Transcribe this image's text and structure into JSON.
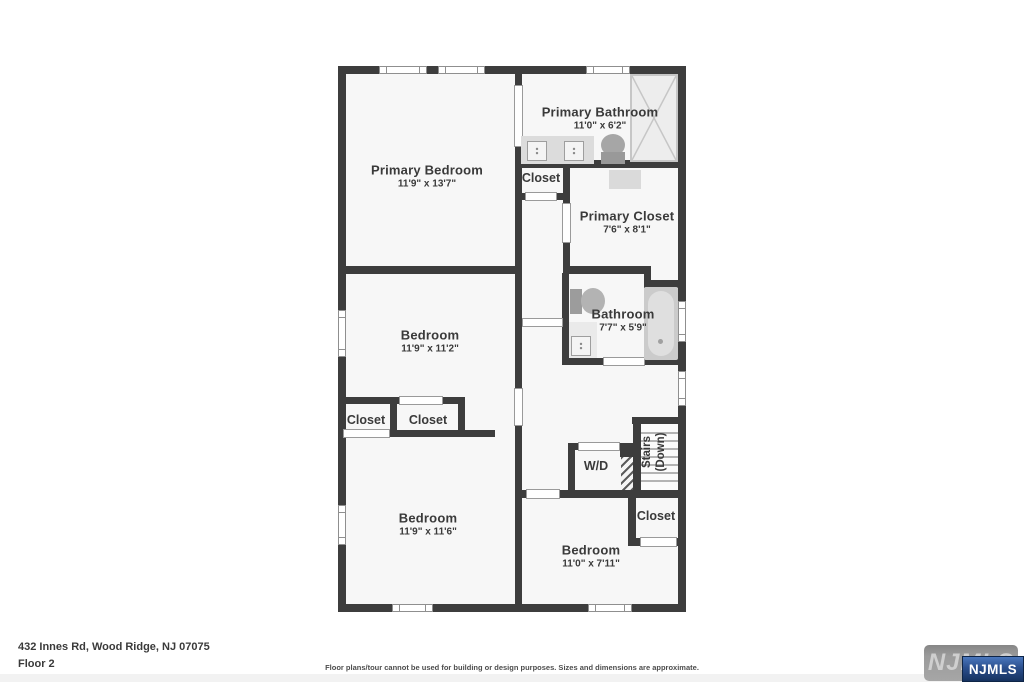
{
  "colors": {
    "wall": "#3d3d3d",
    "floor": "#f7f7f7",
    "label": "#3a3a3a",
    "logo_blue": "#16325f"
  },
  "rooms": {
    "primary_bedroom": {
      "name": "Primary Bedroom",
      "dims": "11'9\" x 13'7\""
    },
    "primary_bathroom": {
      "name": "Primary Bathroom",
      "dims": "11'0\" x 6'2\""
    },
    "hall_closet": {
      "name": "Closet"
    },
    "primary_closet": {
      "name": "Primary Closet",
      "dims": "7'6\" x 8'1\""
    },
    "bedroom_middle": {
      "name": "Bedroom",
      "dims": "11'9\" x 11'2\""
    },
    "bathroom": {
      "name": "Bathroom",
      "dims": "7'7\" x 5'9\""
    },
    "closet_left": {
      "name": "Closet"
    },
    "closet_center": {
      "name": "Closet"
    },
    "laundry": {
      "name": "W/D"
    },
    "stairs": {
      "name": "Stairs",
      "direction": "(Down)"
    },
    "bedroom_bottom_left": {
      "name": "Bedroom",
      "dims": "11'9\" x 11'6\""
    },
    "bedroom_bottom_right": {
      "name": "Bedroom",
      "dims": "11'0\" x 7'11\""
    },
    "closet_bottom_right": {
      "name": "Closet"
    }
  },
  "footer": {
    "address": "432 Innes Rd, Wood Ridge, NJ 07075",
    "floor_label": "Floor 2",
    "disclaimer": "Floor plans/tour cannot be used for building or design purposes. Sizes and dimensions are approximate."
  },
  "logo": {
    "watermark": "NJMLS",
    "badge": "NJMLS"
  }
}
